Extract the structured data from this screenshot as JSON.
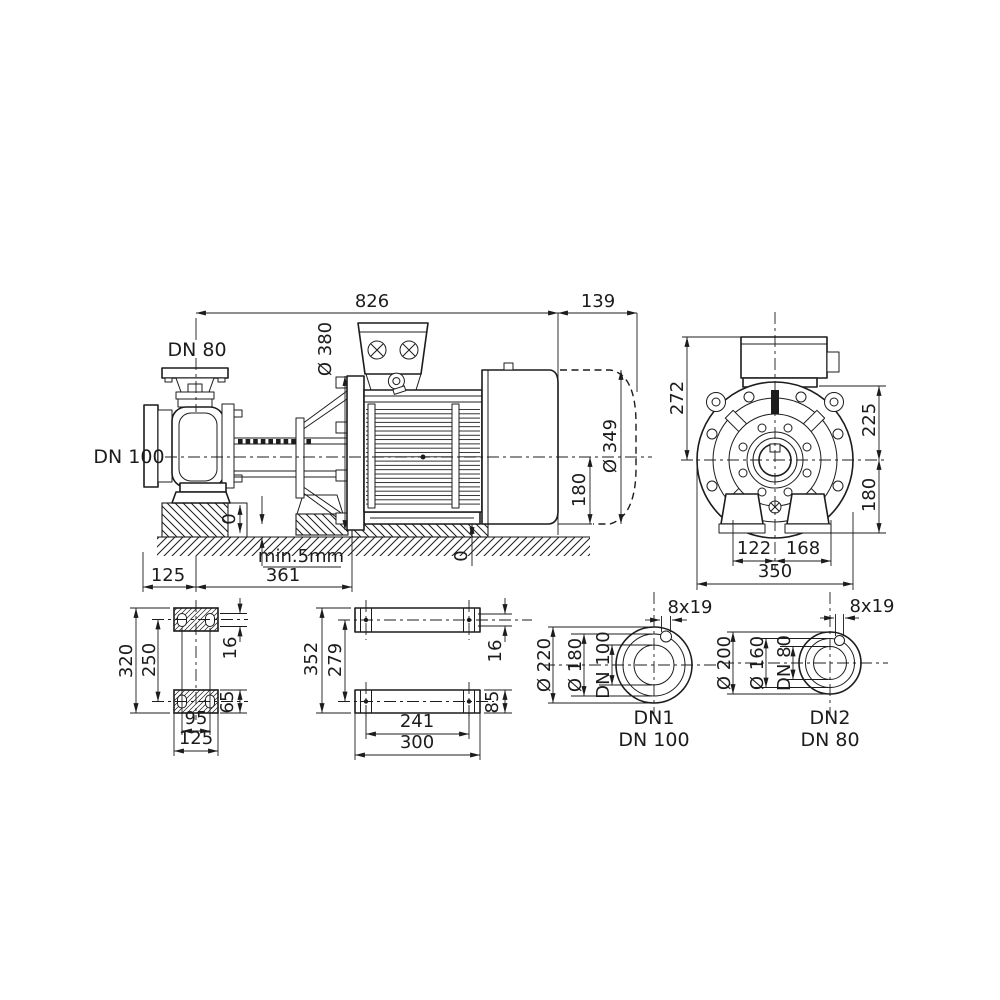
{
  "drawing": {
    "title": "pump dimensional drawing",
    "colors": {
      "line": "#1c1c1c",
      "background": "#ffffff"
    },
    "side_view": {
      "dim_total_length": "826",
      "dim_fan_clearance": "139",
      "suction_flange": "DN 80",
      "discharge_flange": "DN 100",
      "dim_motor_flange_dia": "Ø 380",
      "dim_motor_dia": "Ø 349",
      "dim_axis_to_base": "180",
      "zero_pump": "0",
      "zero_motor": "0",
      "note_min_gap": "min.5mm",
      "dim_axis_to_face": "125",
      "dim_axis_to_flange": "361"
    },
    "end_view": {
      "dim_box_height": "272",
      "dim_axis_to_top": "225",
      "dim_axis_to_base": "180",
      "dim_foot_left": "122",
      "dim_foot_right": "168",
      "dim_overall_width": "350"
    },
    "pump_foot_plan": {
      "dim_length": "320",
      "dim_hole_pitch": "250",
      "dim_slot": "16",
      "dim_foot_width": "65",
      "dim_hole_span": "95",
      "dim_width": "125"
    },
    "motor_foot_plan": {
      "dim_length": "352",
      "dim_hole_pitch": "279",
      "dim_slot": "16",
      "dim_foot_width": "85",
      "dim_hole_span": "241",
      "dim_width": "300"
    },
    "flange_dn1": {
      "bolt_holes": "8x19",
      "outer_dia": "Ø 220",
      "bolt_circle": "Ø 180",
      "bore": "DN 100",
      "port_id": "DN1",
      "port_size": "DN 100"
    },
    "flange_dn2": {
      "bolt_holes": "8x19",
      "outer_dia": "Ø 200",
      "bolt_circle": "Ø 160",
      "bore": "DN 80",
      "port_id": "DN2",
      "port_size": "DN 80"
    }
  }
}
